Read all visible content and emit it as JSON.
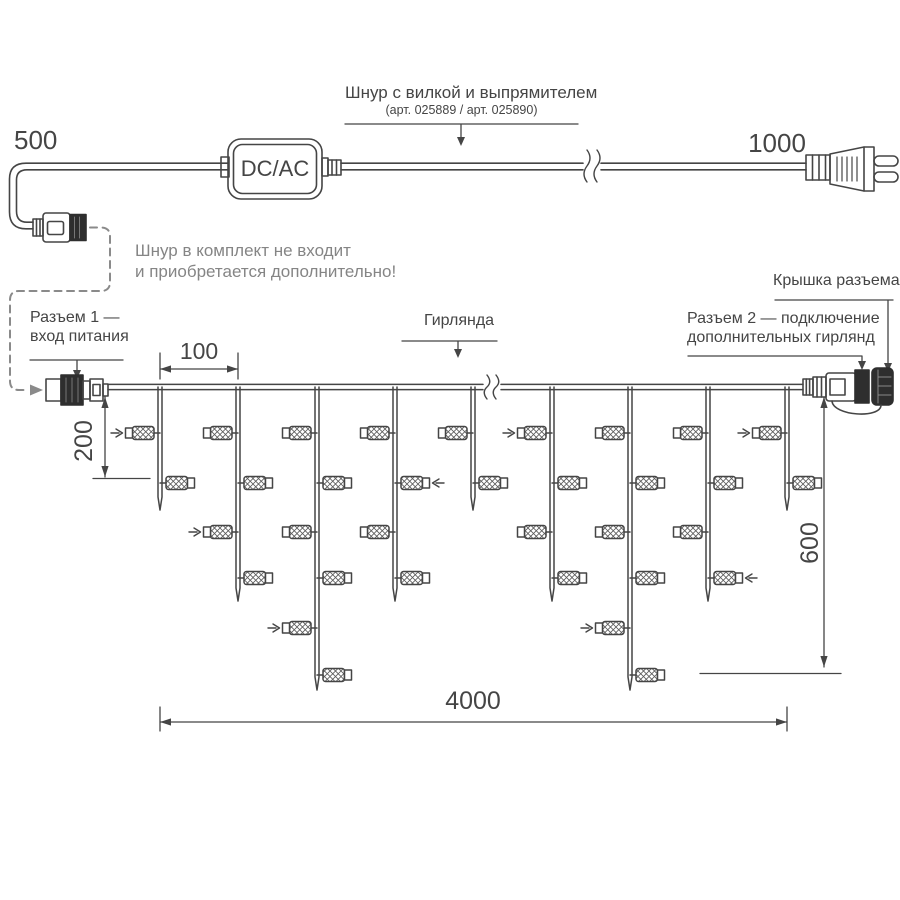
{
  "colors": {
    "line": "#454545",
    "gray_note": "#858585",
    "dark_fill": "#2e2e2e"
  },
  "power_cord": {
    "dim_left": "500",
    "dim_right": "1000",
    "converter": "DC/AC",
    "label": "Шнур с вилкой и выпрямителем",
    "sublabel": "(арт. 025889 / арт. 025890)"
  },
  "note": {
    "line1": "Шнур в комплект не входит",
    "line2": "и приобретается дополнительно!"
  },
  "callouts": {
    "connector1_line1": "Разъем 1 —",
    "connector1_line2": "вход питания",
    "garland": "Гирлянда",
    "connector2_line1": "Разъем 2 — подключение",
    "connector2_line2": "дополнительных гирлянд",
    "cap": "Крышка разъема"
  },
  "dimensions": {
    "drop_spacing": "100",
    "first_drop_length": "200",
    "max_drop_length": "600",
    "total_length": "4000"
  },
  "garland": {
    "wire_y": 387,
    "wire_start_x": 108,
    "wire_end_x": 803,
    "break_x": 490,
    "bulb_row_y": [
      433,
      483,
      532,
      578,
      628,
      675
    ],
    "drops": [
      {
        "x": 160,
        "tip_y": 510,
        "bulbs": [
          {
            "row": 0,
            "side": "left",
            "arrow": true
          },
          {
            "row": 1,
            "side": "right",
            "arrow": false
          }
        ]
      },
      {
        "x": 238,
        "tip_y": 601,
        "bulbs": [
          {
            "row": 0,
            "side": "left",
            "arrow": false
          },
          {
            "row": 1,
            "side": "right",
            "arrow": false
          },
          {
            "row": 2,
            "side": "left",
            "arrow": true
          },
          {
            "row": 3,
            "side": "right",
            "arrow": false
          }
        ]
      },
      {
        "x": 317,
        "tip_y": 690,
        "bulbs": [
          {
            "row": 0,
            "side": "left",
            "arrow": false
          },
          {
            "row": 1,
            "side": "right",
            "arrow": false
          },
          {
            "row": 2,
            "side": "left",
            "arrow": false
          },
          {
            "row": 3,
            "side": "right",
            "arrow": false
          },
          {
            "row": 4,
            "side": "left",
            "arrow": true
          },
          {
            "row": 5,
            "side": "right",
            "arrow": false
          }
        ]
      },
      {
        "x": 395,
        "tip_y": 601,
        "bulbs": [
          {
            "row": 0,
            "side": "left",
            "arrow": false
          },
          {
            "row": 1,
            "side": "right",
            "arrow": true
          },
          {
            "row": 2,
            "side": "left",
            "arrow": false
          },
          {
            "row": 3,
            "side": "right",
            "arrow": false
          }
        ]
      },
      {
        "x": 473,
        "tip_y": 510,
        "bulbs": [
          {
            "row": 0,
            "side": "left",
            "arrow": false
          },
          {
            "row": 1,
            "side": "right",
            "arrow": false
          }
        ]
      },
      {
        "x": 552,
        "tip_y": 601,
        "bulbs": [
          {
            "row": 0,
            "side": "left",
            "arrow": true
          },
          {
            "row": 1,
            "side": "right",
            "arrow": false
          },
          {
            "row": 2,
            "side": "left",
            "arrow": false
          },
          {
            "row": 3,
            "side": "right",
            "arrow": false
          }
        ]
      },
      {
        "x": 630,
        "tip_y": 690,
        "bulbs": [
          {
            "row": 0,
            "side": "left",
            "arrow": false
          },
          {
            "row": 1,
            "side": "right",
            "arrow": false
          },
          {
            "row": 2,
            "side": "left",
            "arrow": false
          },
          {
            "row": 3,
            "side": "right",
            "arrow": false
          },
          {
            "row": 4,
            "side": "left",
            "arrow": true
          },
          {
            "row": 5,
            "side": "right",
            "arrow": false
          }
        ]
      },
      {
        "x": 708,
        "tip_y": 601,
        "bulbs": [
          {
            "row": 0,
            "side": "left",
            "arrow": false
          },
          {
            "row": 1,
            "side": "right",
            "arrow": false
          },
          {
            "row": 2,
            "side": "left",
            "arrow": false
          },
          {
            "row": 3,
            "side": "right",
            "arrow": true
          }
        ]
      },
      {
        "x": 787,
        "tip_y": 510,
        "bulbs": [
          {
            "row": 0,
            "side": "left",
            "arrow": true
          },
          {
            "row": 1,
            "side": "right",
            "arrow": false
          }
        ]
      }
    ]
  }
}
